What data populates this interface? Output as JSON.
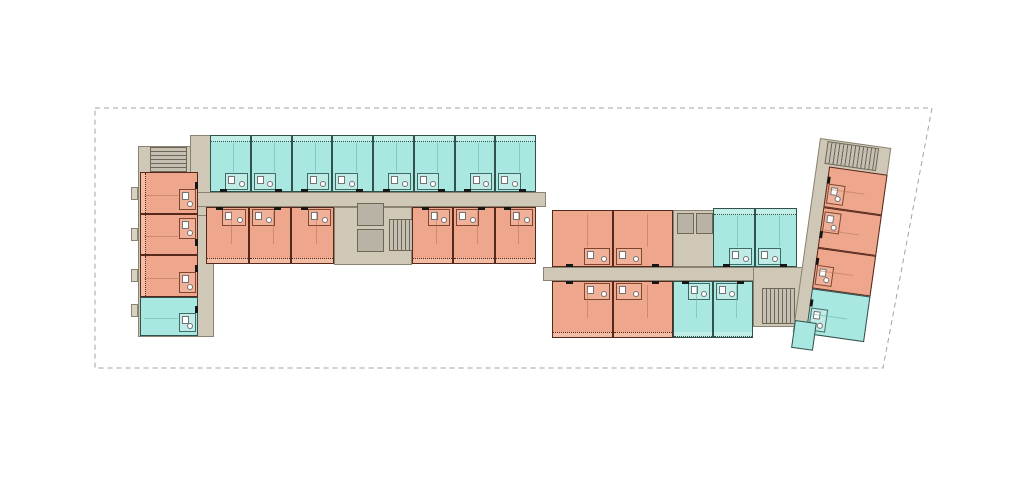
{
  "canvas": {
    "width": 1024,
    "height": 478,
    "background": "#ffffff"
  },
  "colors": {
    "unit_type_a_fill": "#eea78c",
    "unit_type_a_wall": "#55281b",
    "unit_type_b_fill": "#a9e8e1",
    "unit_type_b_wall": "#32504c",
    "corridor_fill": "#cfc8b6",
    "corridor_edge": "#8b8371",
    "core_fill": "#c6c0b2",
    "elevator_fill": "#b9b3a5",
    "boundary_stroke": "#a3a3a3"
  },
  "site": {
    "boundary_points": [
      [
        95,
        108
      ],
      [
        932,
        108
      ],
      [
        883,
        368
      ],
      [
        95,
        368
      ]
    ],
    "dash": "5 4"
  },
  "plan": {
    "groups": [
      {
        "name": "west-building",
        "origin": [
          0,
          0
        ],
        "rotation_deg": 0,
        "rects": [
          {
            "name": "west-wing-base",
            "cls": "tan",
            "r": [
              138,
              146,
              76,
              191
            ]
          },
          {
            "name": "west-wing-connector",
            "cls": "tan",
            "r": [
              190,
              135,
              26,
              81
            ]
          },
          {
            "name": "west-corridor",
            "cls": "tan",
            "r": [
              140,
              192,
              406,
              15
            ]
          },
          {
            "name": "west-core-backing",
            "cls": "tan",
            "r": [
              334,
              207,
              78,
              58
            ]
          },
          {
            "name": "balcony-stub",
            "cls": "tan-stub",
            "r": [
              131,
              187,
              7,
              13
            ]
          },
          {
            "name": "balcony-stub",
            "cls": "tan-stub",
            "r": [
              131,
              228,
              7,
              13
            ]
          },
          {
            "name": "balcony-stub",
            "cls": "tan-stub",
            "r": [
              131,
              269,
              7,
              13
            ]
          },
          {
            "name": "balcony-stub",
            "cls": "tan-stub",
            "r": [
              131,
              304,
              7,
              13
            ]
          }
        ],
        "shafts": [
          {
            "name": "west-elevator-1",
            "r": [
              357,
              203,
              27,
              23
            ]
          },
          {
            "name": "west-elevator-2",
            "r": [
              357,
              229,
              27,
              23
            ]
          }
        ],
        "stairs": [
          {
            "name": "west-core-stair",
            "r": [
              389,
              219,
              26,
              32
            ],
            "dir": "h"
          },
          {
            "name": "west-wing-stair",
            "r": [
              150,
              147,
              37,
              26
            ],
            "dir": "v"
          }
        ],
        "strips": [
          {
            "name": "west-north-units",
            "type": "B",
            "r": [
              210,
              135,
              326,
              57
            ],
            "count": 8,
            "corridor": "bottom",
            "balcony": "top"
          },
          {
            "name": "west-south-units-left",
            "type": "A",
            "r": [
              206,
              207,
              128,
              57
            ],
            "count": 3,
            "corridor": "top",
            "balcony": "bottom"
          },
          {
            "name": "west-south-units-right",
            "type": "A",
            "r": [
              412,
              207,
              124,
              57
            ],
            "count": 3,
            "corridor": "top",
            "balcony": "bottom"
          },
          {
            "name": "west-wing-units",
            "type": "A",
            "r": [
              140,
              172,
              58,
              125
            ],
            "count": 3,
            "vertical": true,
            "corridor": "right",
            "balcony": "left"
          },
          {
            "name": "west-wing-cyan-unit",
            "type": "B",
            "r": [
              140,
              297,
              58,
              39
            ],
            "count": 1,
            "vertical": true,
            "corridor": "right"
          }
        ]
      },
      {
        "name": "east-building",
        "origin": [
          0,
          0
        ],
        "rotation_deg": 0,
        "rects": [
          {
            "name": "east-corridor",
            "cls": "tan",
            "r": [
              543,
              267,
              272,
              14
            ]
          },
          {
            "name": "east-stair-area",
            "cls": "tan",
            "r": [
              753,
              267,
              65,
              60
            ]
          },
          {
            "name": "east-elevator-backing",
            "cls": "tan",
            "r": [
              673,
              210,
              42,
              57
            ]
          }
        ],
        "shafts": [
          {
            "name": "east-elevator-1",
            "r": [
              677,
              213,
              17,
              21
            ]
          },
          {
            "name": "east-elevator-2",
            "r": [
              696,
              213,
              17,
              21
            ]
          }
        ],
        "stairs": [
          {
            "name": "east-stair",
            "r": [
              762,
              288,
              33,
              36
            ],
            "dir": "h"
          }
        ],
        "strips": [
          {
            "name": "east-salmon-top",
            "type": "A",
            "r": [
              552,
              210,
              121,
              57
            ],
            "count": 2,
            "corridor": "bottom"
          },
          {
            "name": "east-salmon-bottom",
            "type": "A",
            "r": [
              552,
              281,
              121,
              57
            ],
            "count": 2,
            "corridor": "top",
            "balcony": "bottom"
          },
          {
            "name": "east-cyan-top",
            "type": "B",
            "r": [
              713,
              208,
              84,
              59
            ],
            "count": 2,
            "corridor": "bottom",
            "balcony": "top"
          },
          {
            "name": "east-cyan-bottom",
            "type": "B",
            "r": [
              673,
              281,
              80,
              57
            ],
            "count": 2,
            "corridor": "top",
            "balcony": "bottom"
          }
        ]
      },
      {
        "name": "angled-wing",
        "origin": [
          820,
          138
        ],
        "rotation_deg": 8,
        "rects": [
          {
            "name": "wing-base",
            "cls": "tan",
            "r": [
              0,
              0,
              72,
              196
            ]
          }
        ],
        "stairs": [
          {
            "name": "wing-stair",
            "r": [
              8,
              2,
              52,
              23
            ],
            "dir": "h"
          }
        ],
        "strips": [
          {
            "name": "wing-salmon-units",
            "type": "A",
            "r": [
              13,
              27,
              59,
              123
            ],
            "count": 3,
            "vertical": true,
            "corridor": "left"
          },
          {
            "name": "wing-cyan-unit",
            "type": "B",
            "r": [
              13,
              150,
              59,
              46
            ],
            "count": 1,
            "vertical": true,
            "corridor": "left"
          }
        ]
      },
      {
        "name": "wing-annex",
        "origin": [
          795,
          320
        ],
        "rotation_deg": 8,
        "rects": [
          {
            "name": "wing-annex-cyan",
            "cls": "b-annex",
            "r": [
              0,
              0,
              22,
              28
            ]
          }
        ]
      }
    ]
  },
  "summary": {
    "unit_counts": {
      "type_a_salmon": 16,
      "type_b_cyan": 16
    },
    "cores": {
      "stairs": 4,
      "elevators": 4
    }
  }
}
